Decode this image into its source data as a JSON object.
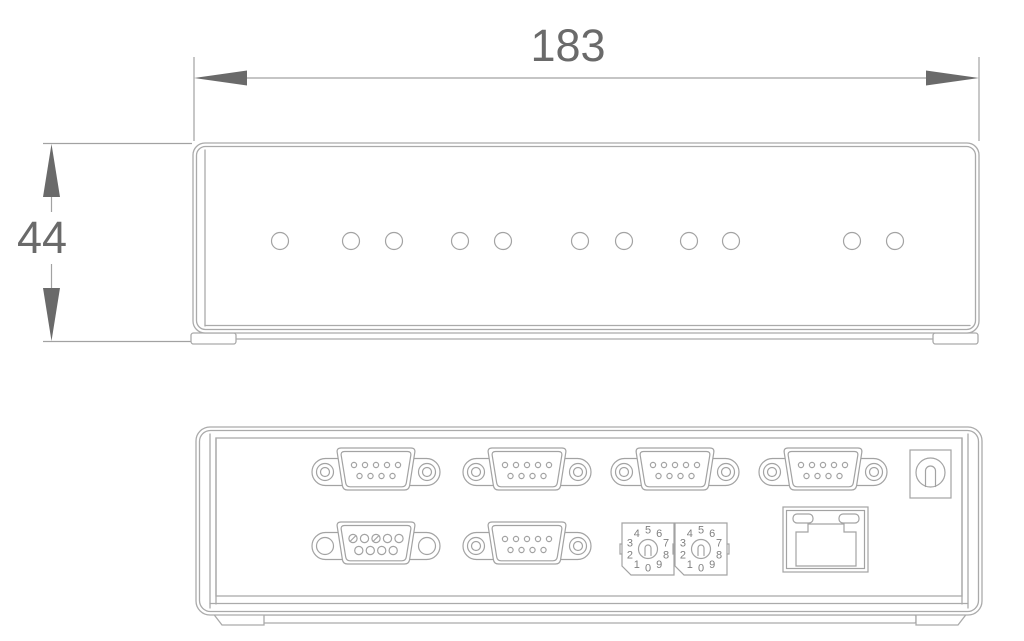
{
  "drawing": {
    "kind": "mechanical-dimension-drawing",
    "background": "#ffffff"
  },
  "colors": {
    "outline": "#aaaaaa",
    "connector_line": "#a3a3a3",
    "dimension_line": "#a2a2a2",
    "dimension_accent": "#6a6a6a",
    "digit": "#808080"
  },
  "dimension_annotations": {
    "width_label": "183",
    "height_label": "44"
  },
  "front_view": {
    "name": "front-panel-view",
    "led_count": 11,
    "led_positions": [
      280,
      351,
      394,
      460,
      503,
      580,
      624,
      689,
      731,
      852,
      895
    ],
    "led_row_y": 241,
    "led_radius": 8.5
  },
  "rear_view": {
    "name": "rear-panel-view",
    "db9_ports": {
      "top_row_centers_x": [
        376,
        527,
        675,
        823
      ],
      "top_row_y": 472,
      "bottom_row": [
        {
          "type": "female",
          "x": 376
        },
        {
          "type": "male",
          "x": 527
        }
      ],
      "bottom_row_y": 546
    },
    "rotary_switches": {
      "digits": [
        "0",
        "1",
        "2",
        "3",
        "4",
        "5",
        "6",
        "7",
        "8",
        "9"
      ],
      "centers_x": [
        648,
        701
      ],
      "center_y": 549,
      "digit_ring_radius": 19
    },
    "ethernet_port": {
      "x": 783,
      "y": 507,
      "width": 85,
      "height": 65
    },
    "power_jack": {
      "x": 910,
      "y": 450,
      "width": 41,
      "height": 48
    }
  }
}
